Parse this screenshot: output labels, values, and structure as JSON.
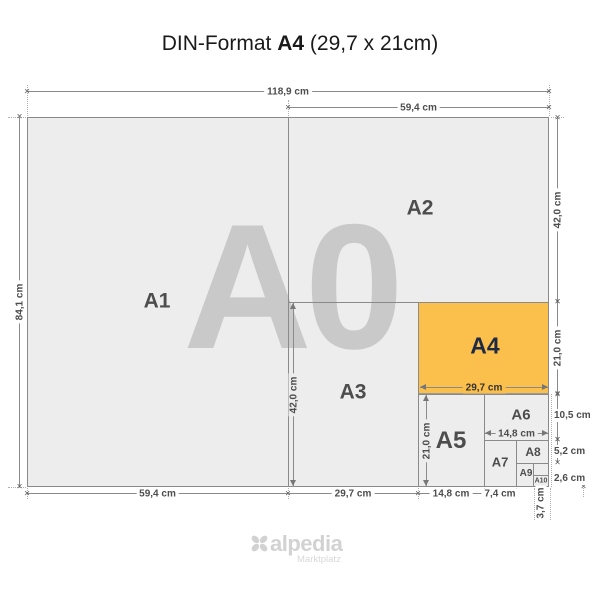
{
  "title": {
    "prefix": "DIN-Format",
    "emphasis": "A4",
    "suffix": "(29,7 x 21cm)"
  },
  "watermark": "A0",
  "papers": [
    {
      "id": "a1",
      "label": "A1"
    },
    {
      "id": "a2",
      "label": "A2"
    },
    {
      "id": "a3",
      "label": "A3"
    },
    {
      "id": "a4",
      "label": "A4"
    },
    {
      "id": "a5",
      "label": "A5"
    },
    {
      "id": "a6",
      "label": "A6"
    },
    {
      "id": "a7",
      "label": "A7"
    },
    {
      "id": "a8",
      "label": "A8"
    },
    {
      "id": "a9",
      "label": "A9"
    },
    {
      "id": "a10",
      "label": "A10"
    }
  ],
  "dims": {
    "total_width": "118,9 cm",
    "half_width_top": "59,4 cm",
    "total_height": "84,1 cm",
    "a2_height": "42,0 cm",
    "a4_height": "21,0 cm",
    "a6_height": "10,5 cm",
    "a8_height": "5,2 cm",
    "a10_height": "2,6 cm",
    "a1_width_bottom": "59,4 cm",
    "a3_width_bottom": "29,7 cm",
    "a5_width_bottom": "14,8 cm",
    "a7_width_bottom": "7,4 cm",
    "a10_width": "3,7 cm",
    "a3_height_inner": "42,0 cm",
    "a5_height_inner": "21,0 cm",
    "a4_width_inner": "29,7 cm",
    "a6_width_inner": "14,8 cm"
  },
  "logo": {
    "name": "alpedia",
    "tagline": "Marktplatz"
  },
  "colors": {
    "accent": "#FBBF4B",
    "paper_fill": "#EDEDED",
    "border": "#8A8A8A",
    "watermark": "#C9C9C9",
    "label": "#4D4D4D",
    "a4_label": "#1E2A44",
    "dim_text": "#4D4D4D",
    "logo": "#D2D2D2"
  }
}
